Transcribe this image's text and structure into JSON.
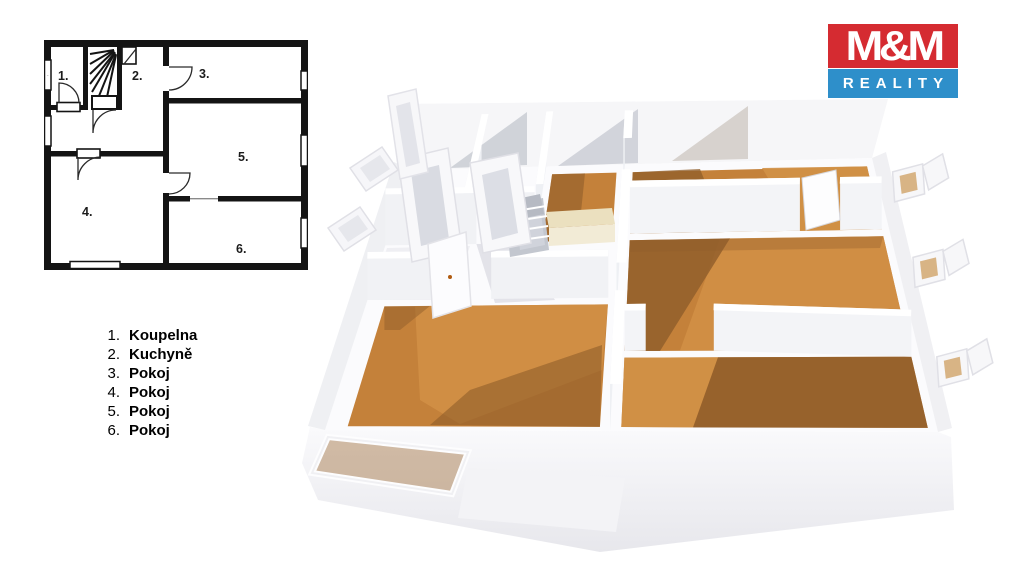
{
  "logo": {
    "top_text": "M&M",
    "bottom_text": "REALITY",
    "red": "#d52b31",
    "blue": "#2e8fca"
  },
  "legend": {
    "items": [
      {
        "number": "1.",
        "label": "Koupelna"
      },
      {
        "number": "2.",
        "label": "Kuchyně"
      },
      {
        "number": "3.",
        "label": "Pokoj"
      },
      {
        "number": "4.",
        "label": "Pokoj"
      },
      {
        "number": "5.",
        "label": "Pokoj"
      },
      {
        "number": "6.",
        "label": "Pokoj"
      }
    ]
  },
  "plan2d": {
    "room_labels": [
      "1.",
      "2.",
      "3.",
      "4.",
      "5.",
      "6."
    ]
  },
  "colors": {
    "wood": "#c4813a",
    "wood_light": "#d29147",
    "wood_dark": "#8f5d2a",
    "wall_face": "#eef0f4",
    "wall_top": "#ffffff",
    "plan_line": "#141414"
  }
}
